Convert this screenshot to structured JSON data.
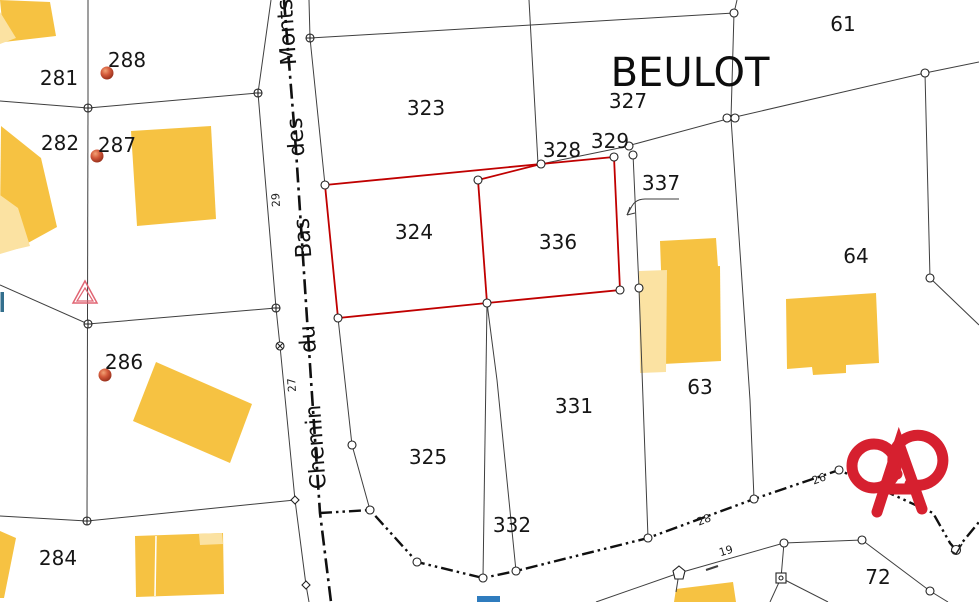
{
  "title": "Cadastral map extract",
  "place_label": "BEULOT",
  "parcel_numbers": {
    "p281": "281",
    "p282": "282",
    "p284": "284",
    "p286": "286",
    "p287": "287",
    "p288": "288",
    "p323": "323",
    "p324": "324",
    "p325": "325",
    "p327": "327",
    "p328": "328",
    "p329": "329",
    "p331": "331",
    "p332": "332",
    "p336": "336",
    "p337": "337",
    "p61": "61",
    "p63": "63",
    "p64": "64",
    "p72": "72"
  },
  "road_name": {
    "full": "Chemin du Bas des Monts",
    "words": {
      "chemin": "Chemin",
      "du": "du",
      "bas": "Bas",
      "des": "des",
      "monts": "Monts"
    }
  },
  "small_numbers": {
    "n19": "19",
    "n26": "26",
    "n27": "27",
    "n28": "28",
    "n29": "29"
  },
  "icons": {
    "logo": "alsace-heart-pretzel-logo",
    "survey_dot": "address-point-dot",
    "triangle": "geodetic-triangle-marker",
    "vertex": "parcel-vertex-circle"
  },
  "colors": {
    "building_fill": "#F6C242",
    "building_light_fill": "#FBE2A2",
    "highlight_outline": "#C00000",
    "boundary_line": "#3F3F3F",
    "logo_red": "#D6202F",
    "dot_orange": "#D3593A",
    "water_blue": "#2F7CBE",
    "triangle_pink": "#E16573"
  }
}
